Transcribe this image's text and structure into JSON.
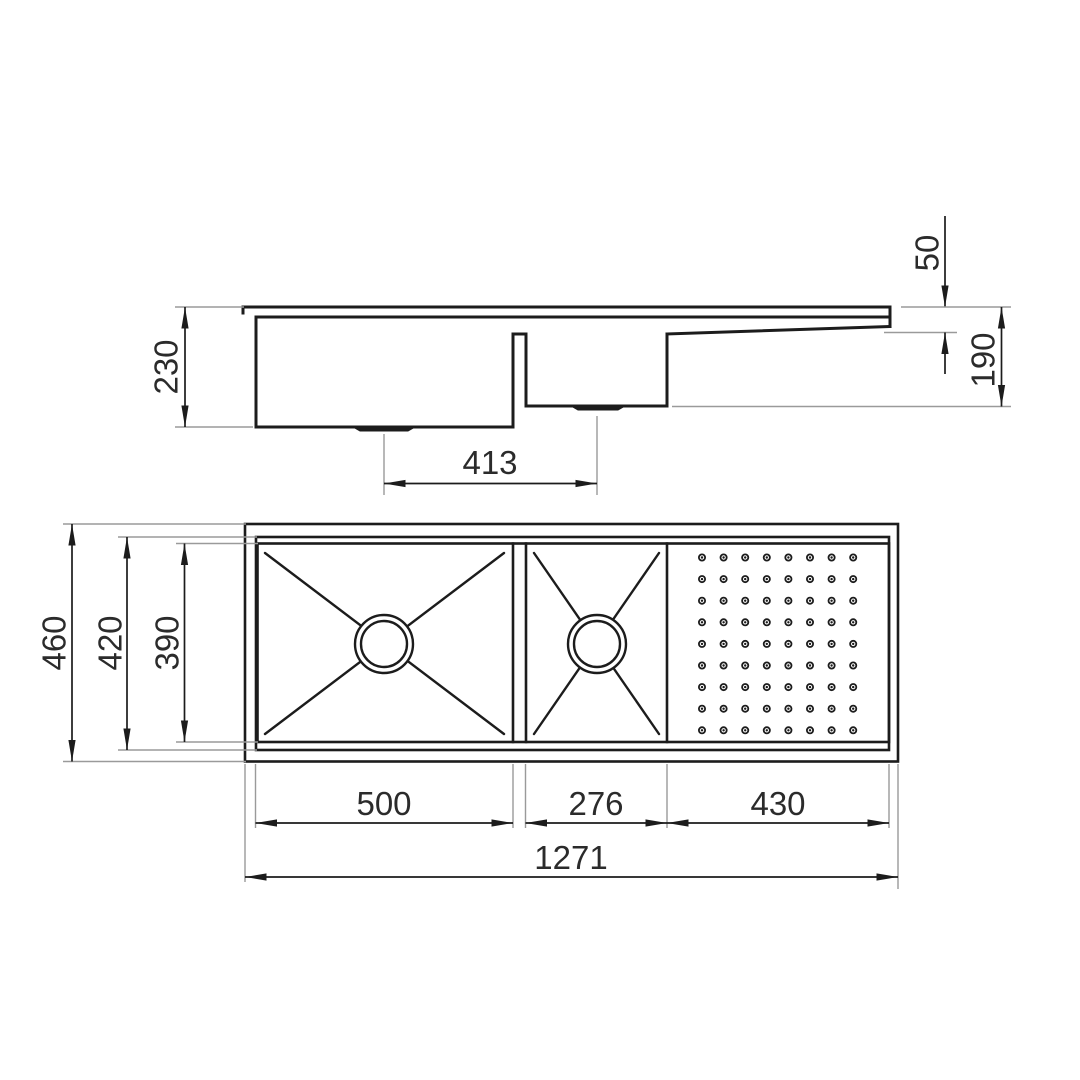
{
  "drawing": {
    "kind": "technical-dimension-drawing",
    "subject": "double-bowl-kitchen-sink-with-drainer",
    "colors": {
      "line": "#1c1c1c",
      "ext": "#9a9a9a",
      "text": "#2b2b2b",
      "bg": "#ffffff"
    },
    "side_view": {
      "dims": {
        "bowl1_depth": "230",
        "drain_centers": "413",
        "drainer_end_drop": "50",
        "bowl2_depth": "190"
      }
    },
    "plan_view": {
      "dims": {
        "overall_width": "460",
        "flange_inner_width": "420",
        "bowl_width": "390",
        "bowl1_length": "500",
        "bowl2_length": "276",
        "drainer_length": "430",
        "overall_length": "1271"
      },
      "drainer_pattern": {
        "rows": 9,
        "cols": 8
      }
    }
  }
}
